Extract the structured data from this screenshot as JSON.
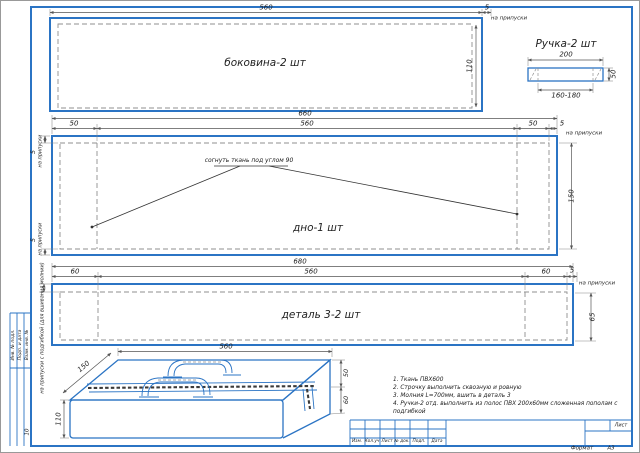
{
  "frame": {
    "format_label": "Формат",
    "format_value": "А3",
    "sheet_label": "Лист",
    "stamp_columns": [
      "Инв. № подл.",
      "Подп. и дата",
      "Взам. инв. №"
    ],
    "stamp_number": "10",
    "title_columns": [
      "Изм.",
      "Кол.уч",
      "Лист",
      "№ док.",
      "Подп.",
      "Дата"
    ]
  },
  "side_view": {
    "title": "боковина-2 шт",
    "dim_width": "560",
    "dim_allowance": "5",
    "allowance_note": "на припуски",
    "dim_height": "110"
  },
  "handle_view": {
    "title": "Ручка-2 шт",
    "dim_width": "200",
    "dim_inner": "160-180",
    "dim_height": "50"
  },
  "bottom_view": {
    "title": "дно-1 шт",
    "fold_note": "согнуть ткань под углом 90",
    "dim_total": "660",
    "dim_left": "50",
    "dim_center": "560",
    "dim_right": "50",
    "dim_allowance": "5",
    "allowance_note": "на припуски",
    "dim_height": "150",
    "left_allowance_top": "5",
    "left_allowance_top_note": "на припуски",
    "left_allowance_bottom": "5",
    "left_allowance_bottom_note": "на припуски"
  },
  "detail3_view": {
    "title": "деталь 3-2 шт",
    "dim_total": "680",
    "dim_left": "60",
    "dim_center": "560",
    "dim_right": "60",
    "dim_allowance": "5",
    "allowance_note": "на припуски",
    "dim_height": "65",
    "side_note": "на припуски с подгибкой (для вшивания молнии)"
  },
  "iso_view": {
    "dim_width": "560",
    "dim_depth": "150",
    "dim_height": "110",
    "dim_top": "50",
    "dim_bottom": "60"
  },
  "notes": {
    "line1": "1. Ткань ПВХ600",
    "line2": "2. Строчку выполнить сквозную и ровную",
    "line3": "3. Молния L=700мм, вшить в деталь 3",
    "line4": "4. Ручки-2 отд. выполнить из полос ПВХ 200х60мм сложенная пополам с подгибкой"
  }
}
